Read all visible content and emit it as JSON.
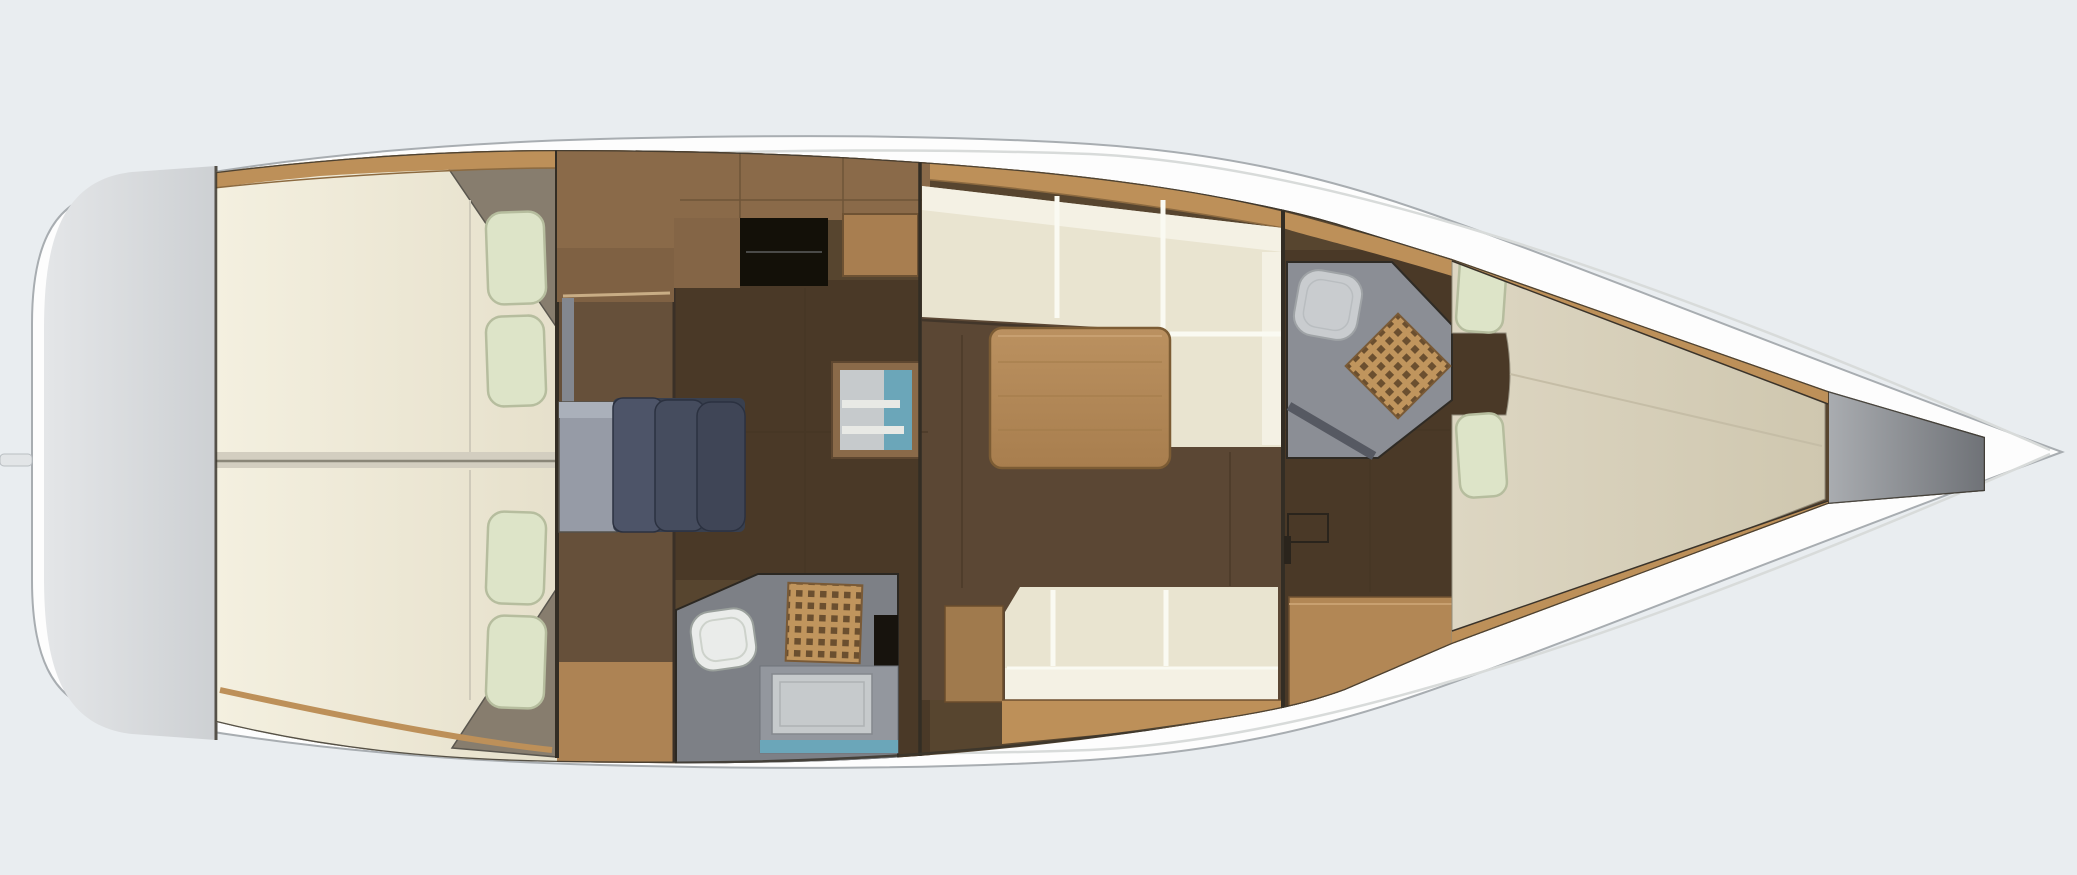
{
  "diagram": {
    "type": "yacht-interior-floor-plan",
    "orientation": "bow-right",
    "rooms": [
      {
        "id": "transom-swim-platform"
      },
      {
        "id": "aft-cabin-port",
        "features": [
          "double-berth",
          "two-pillows",
          "wardrobe-wedge"
        ]
      },
      {
        "id": "aft-cabin-starboard",
        "features": [
          "double-berth",
          "two-pillows",
          "wardrobe-wedge"
        ]
      },
      {
        "id": "companionway",
        "features": [
          "landing",
          "steps"
        ]
      },
      {
        "id": "galley",
        "features": [
          "counter",
          "stove",
          "sink-fridge-unit"
        ]
      },
      {
        "id": "aft-head",
        "features": [
          "toilet",
          "shower-grate",
          "vanity-sink"
        ]
      },
      {
        "id": "salon",
        "features": [
          "l-settee",
          "dining-table",
          "straight-settee",
          "locker"
        ]
      },
      {
        "id": "forward-head",
        "features": [
          "toilet",
          "shower-grate",
          "door"
        ]
      },
      {
        "id": "forward-cabin",
        "features": [
          "v-berth",
          "two-pillows",
          "desk-seat"
        ]
      },
      {
        "id": "forepeak-locker"
      }
    ]
  },
  "colors": {
    "background": "#e9edf0",
    "hull": "#fdfdfd",
    "hull_outline": "#a8adb1",
    "deck_line": "#d8dbda",
    "transom_light": "#e4e6e8",
    "transom_dark": "#cdd0d3",
    "transom_edge": "#55514a",
    "interior_outline": "#3a352c",
    "floor_base": "#57452f",
    "floor_dark": "#4a3927",
    "floor_mid": "#66503a",
    "floor_salon": "#5b4734",
    "floor_plank": "#463625",
    "sole_light": "#ad8354",
    "bulkhead": "#332d24",
    "wood_trim": "#bd9059",
    "wood_trim_dark": "#8c6a40",
    "wood_counter": "#8a6a49",
    "wood_counter_dark": "#7f6143",
    "wood_under": "#846546",
    "wood_cabinet": "#a87e50",
    "wood_locker": "#a07a4d",
    "desk_wood": "#b28755",
    "table_light": "#bb9160",
    "table_dark": "#a87e4e",
    "table_edge": "#7c5c34",
    "bed_hi": "#f4f0e0",
    "bed_lo": "#e6e0cb",
    "berth_hi": "#ddd6c2",
    "berth_lo": "#cfc7af",
    "bed_divider": "#d3cec0",
    "bed_seam": "#8a8678",
    "pillow": "#dde4c8",
    "pillow_edge": "#b6bd9e",
    "settee": "#e9e4d0",
    "settee_back": "#f4f1e4",
    "seam_white": "#fafaf2",
    "wedge": "#877d6e",
    "steps_base": "#39404f",
    "steps_dark1": "#4d5468",
    "steps_dark2": "#454c5e",
    "steps_dark3": "#3f4556",
    "steps_light": "#969ba6",
    "steps_light_top": "#aab0ba",
    "steps_wall": "#83878f",
    "head_floor": "#7d8086",
    "head_floor_fwd": "#8b8e95",
    "head_door": "#565962",
    "toilet": "#eaecea",
    "toilet_fwd": "#c9cccf",
    "toilet_edge": "#9aa09c",
    "grate_wood": "#c0955d",
    "grate_hole": "#6b4f2f",
    "grate_edge": "#7a5a36",
    "vanity": "#93979e",
    "basin": "#c6cacc",
    "sink_teal": "#6ba6b9",
    "sink_shelf": "#e8e9e5",
    "locker_black": "#17130d",
    "stove": "#131008",
    "stove_line": "#4a4a48",
    "door_dark": "#2a241c",
    "forepeak_light": "#a9acb0",
    "forepeak_dark": "#6f7277"
  }
}
